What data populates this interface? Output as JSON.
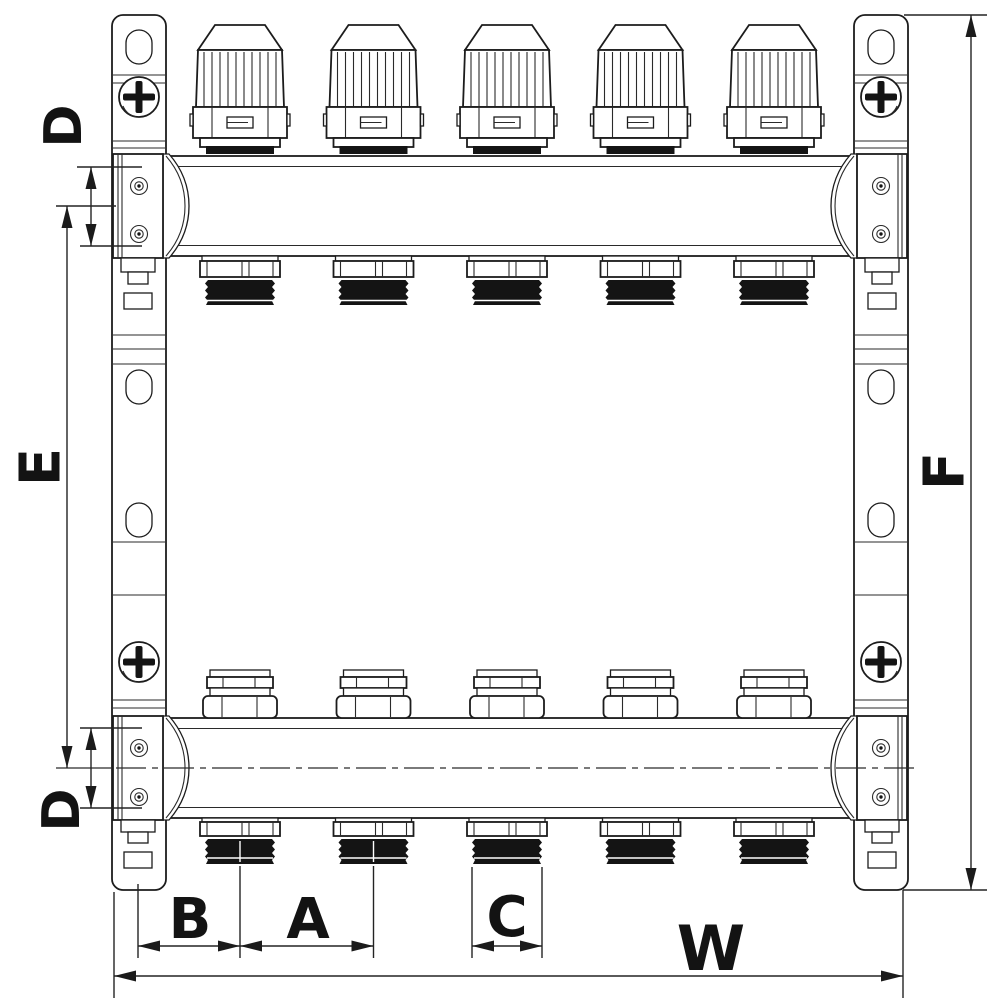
{
  "drawing": {
    "description_colors": {
      "line": "#1c1c1c",
      "background": "#ffffff",
      "thread_fill": "#141414"
    },
    "labels": {
      "d_top": "D",
      "e": "E",
      "d_bottom": "D",
      "b": "B",
      "a": "A",
      "c": "C",
      "w": "W",
      "f": "F"
    }
  }
}
